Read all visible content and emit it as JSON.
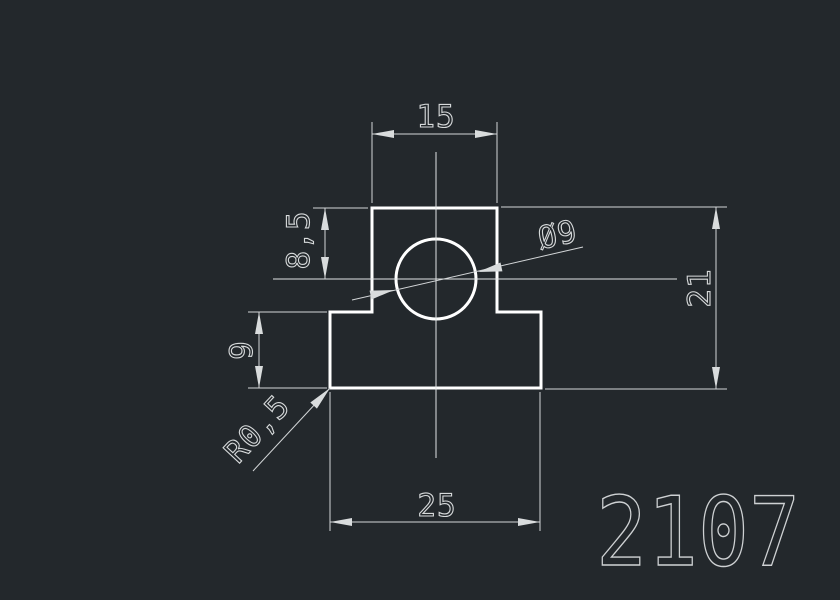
{
  "app": {
    "background_color": "#23282c",
    "outline_color": "#ffffff",
    "dimension_color": "#d3d6d8"
  },
  "drawing": {
    "part_number": "2107",
    "dims": {
      "top_width": "15",
      "upper_height": "8,5",
      "lower_height": "9",
      "total_height": "21",
      "bottom_width": "25",
      "fillet_radius": "R0,5",
      "hole_diameter": "Ø9"
    }
  }
}
